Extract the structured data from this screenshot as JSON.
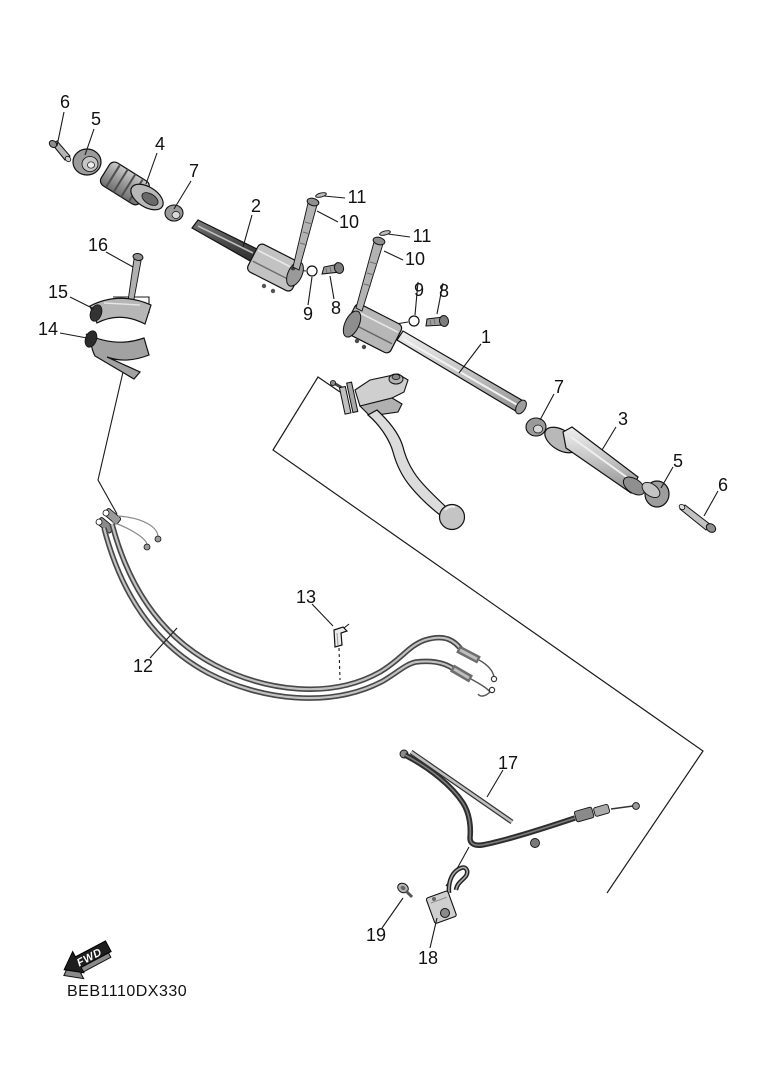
{
  "diagram": {
    "code": "BEB1110DX330",
    "fwd_label": "FWD",
    "background_color": "#ffffff",
    "line_color": "#1a1a1a",
    "type": "exploded-parts-diagram",
    "subject": "steering handle assembly with grips, clamps, levers and cables"
  },
  "callouts": [
    {
      "label": "6"
    },
    {
      "label": "5"
    },
    {
      "label": "4"
    },
    {
      "label": "7"
    },
    {
      "label": "2"
    },
    {
      "label": "16"
    },
    {
      "label": "15"
    },
    {
      "label": "14"
    },
    {
      "label": "11"
    },
    {
      "label": "10"
    },
    {
      "label": "11"
    },
    {
      "label": "10"
    },
    {
      "label": "9"
    },
    {
      "label": "8"
    },
    {
      "label": "9"
    },
    {
      "label": "8"
    },
    {
      "label": "1"
    },
    {
      "label": "7"
    },
    {
      "label": "3"
    },
    {
      "label": "5"
    },
    {
      "label": "6"
    },
    {
      "label": "13"
    },
    {
      "label": "12"
    },
    {
      "label": "17"
    },
    {
      "label": "19"
    },
    {
      "label": "18"
    }
  ]
}
